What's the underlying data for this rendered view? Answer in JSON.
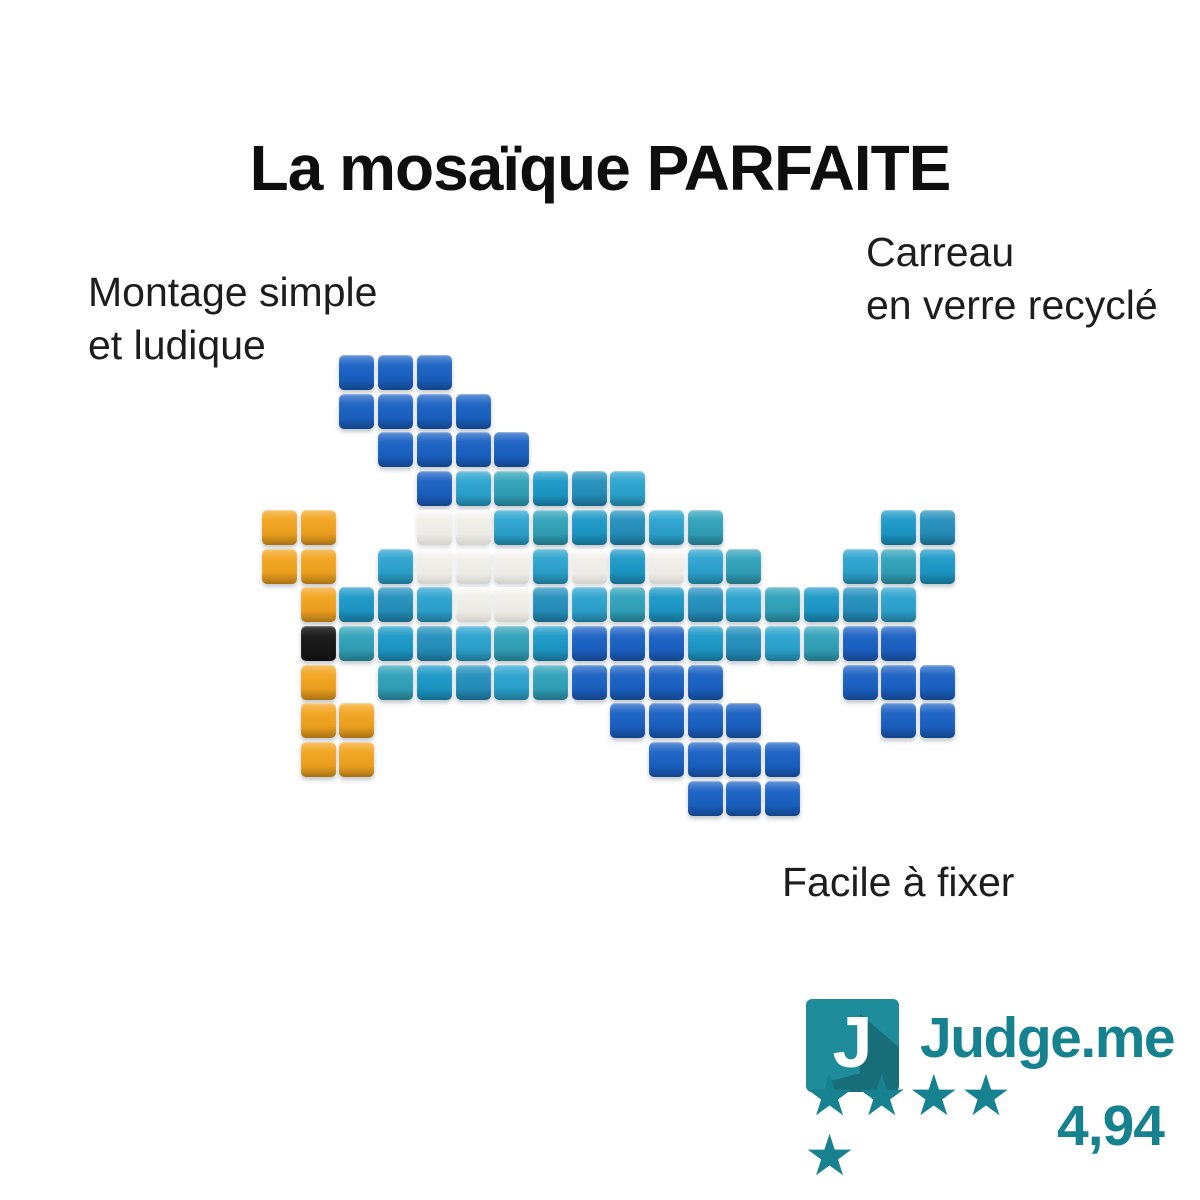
{
  "title": "La mosaïque PARFAITE",
  "labels": {
    "top_left": {
      "lines": [
        "Montage simple",
        "et ludique"
      ]
    },
    "top_right": {
      "lines": [
        "Carreau",
        "en verre recyclé"
      ]
    },
    "bottom": {
      "text": "Facile à fixer"
    }
  },
  "mosaic": {
    "subject": "pixel-art airplane made of glass mosaic tiles",
    "legend": {
      "B": "royal-blue",
      "T": "teal-azure",
      "W": "white",
      "O": "orange",
      "K": "black",
      ".": "empty"
    },
    "colors": {
      "B": "#1a61c4",
      "T": "#1c99c8",
      "W": "#f1efe9",
      "O": "#f3a41e",
      "K": "#191919"
    },
    "teal_variants": [
      "#1c99c8",
      "#2490bd",
      "#2ba4cf",
      "#30a2ba"
    ],
    "grid": [
      "..BBB.............",
      "..BBBB............",
      "...BBBB...........",
      "....BTTTTT........",
      "OO..WWTTTTTT....TT",
      "OO.TWWWTWTWTT..TTT",
      ".OTTTWWTTTTTTTTTT.",
      ".KTTTTTTBBBTTTTBB.",
      ".O.TTTTTBBBB...BBB",
      ".OO......BBBB...BB",
      ".OO.......BBBB....",
      "...........BBB...."
    ]
  },
  "review": {
    "brand": "Judge.me",
    "logo_letter": "J",
    "stars": 5,
    "star_char": "★",
    "rating": "4,94",
    "square_color": "#1e8c9a",
    "accent_color": "#17828f"
  }
}
